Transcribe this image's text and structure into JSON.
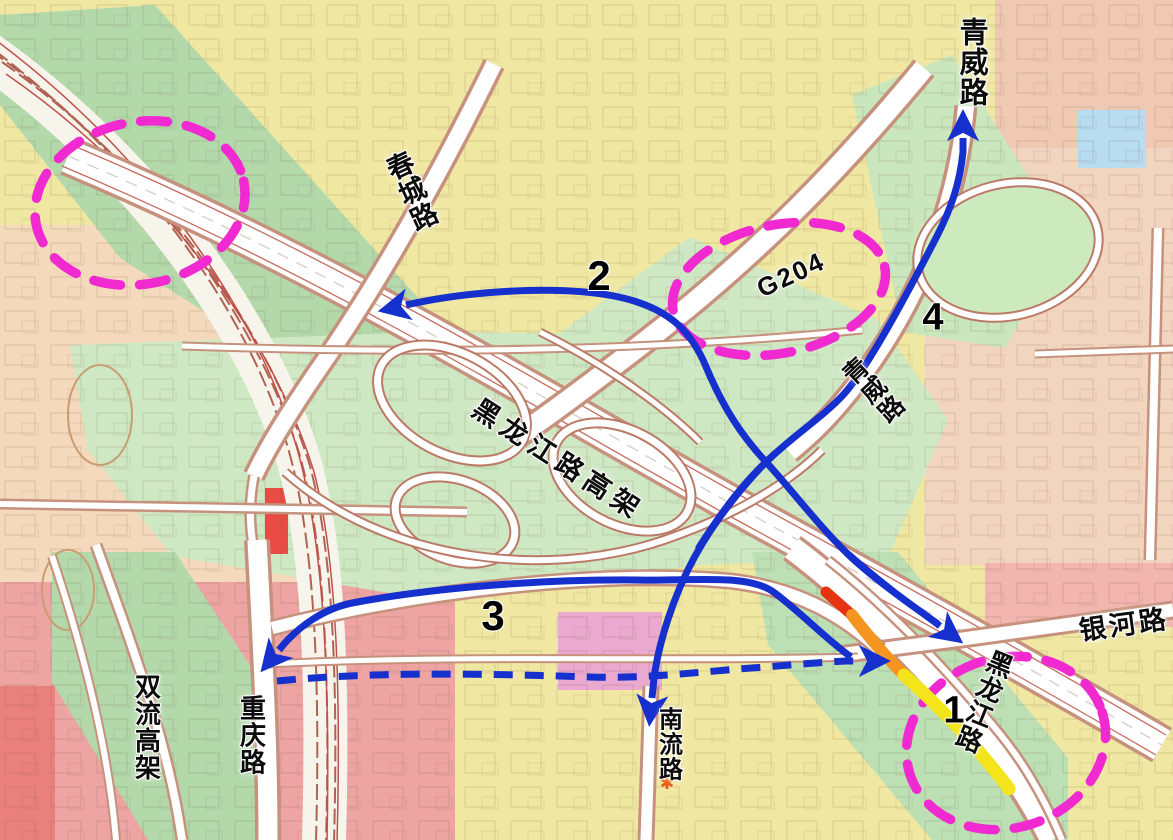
{
  "figure": {
    "kind": "traffic-detour-planning-map",
    "width_px": 1173,
    "height_px": 840
  },
  "colors": {
    "route_arrow_blue": "#1530cd",
    "highlight_magenta": "#f02ad0",
    "congestion_severe_red": "#e63312",
    "congestion_moderate_orange": "#f5941e",
    "congestion_light_yellow": "#f4e41c",
    "parcel_yellow": "#f0e8a2",
    "parcel_green": "#cfe8c4",
    "parcel_salmon": "#f5d9bc",
    "parcel_pink": "#eda4a2",
    "parcel_blue": "#b8dcf0"
  },
  "map": {
    "road_labels": [
      {
        "id": "qingwei-road-north",
        "text": "青威路",
        "x": 971,
        "y": 62,
        "rot": 0,
        "vertical": true,
        "size": 29
      },
      {
        "id": "chuncheng-road",
        "text": "春城路",
        "x": 410,
        "y": 192,
        "rot": -25,
        "vertical": true,
        "size": 27
      },
      {
        "id": "g204",
        "text": "G204",
        "x": 791,
        "y": 275,
        "rot": -25,
        "vertical": false,
        "size": 26,
        "spacing": 2
      },
      {
        "id": "heilongjiang-viaduct",
        "text": "黑龙江路高架",
        "x": 558,
        "y": 460,
        "rot": 33,
        "vertical": false,
        "size": 27,
        "spacing": 6
      },
      {
        "id": "qingwei-road-mid",
        "text": "青威路",
        "x": 872,
        "y": 391,
        "rot": -43,
        "vertical": true,
        "size": 25
      },
      {
        "id": "yinhe-road",
        "text": "银河路",
        "x": 1124,
        "y": 625,
        "rot": -8,
        "vertical": false,
        "size": 27,
        "spacing": 3
      },
      {
        "id": "heilongjiang-road",
        "text": "黑龙江路",
        "x": 983,
        "y": 701,
        "rot": 22,
        "vertical": true,
        "size": 26
      },
      {
        "id": "shuangliu-viaduct",
        "text": "双流高架",
        "x": 146,
        "y": 727,
        "rot": 0,
        "vertical": true,
        "size": 26
      },
      {
        "id": "chongqing-road",
        "text": "重庆路",
        "x": 251,
        "y": 735,
        "rot": 0,
        "vertical": true,
        "size": 26
      },
      {
        "id": "nanliu-road",
        "text": "南流路",
        "x": 667,
        "y": 744,
        "rot": 0,
        "vertical": true,
        "size": 24
      }
    ],
    "route_numbers": [
      {
        "id": "1",
        "text": "1",
        "x": 954,
        "y": 711,
        "size": 38
      },
      {
        "id": "2",
        "text": "2",
        "x": 599,
        "y": 276,
        "size": 42
      },
      {
        "id": "3",
        "text": "3",
        "x": 493,
        "y": 616,
        "size": 42
      },
      {
        "id": "4",
        "text": "4",
        "x": 933,
        "y": 318,
        "size": 38
      }
    ],
    "routes": [
      {
        "id": "2-to-chuncheng",
        "d": "M 938 624 C 908 603 876 580 852 558 C 820 528 792 490 766 462 C 741 435 723 407 707 369 C 692 332 670 307 614 296 C 556 285 468 291 406 305"
      },
      {
        "id": "1-to-heilongjiang",
        "d": "M 848 554 C 880 582 904 600 924 614 L 940 626"
      },
      {
        "id": "4-to-qingwei",
        "d": "M 698 549 C 724 508 744 483 766 462 C 794 435 824 416 844 394 C 868 367 906 296 936 238 C 952 207 960 182 963 152 L 963 138"
      },
      {
        "id": "4-to-nanliu",
        "d": "M 770 458 C 744 484 714 521 694 558 C 674 595 659 641 654 678 L 652 698"
      },
      {
        "id": "3-to-chongqing",
        "d": "M 851 657 C 827 640 795 607 772 591 C 746 574 696 581 638 580 C 528 579 420 590 352 603 C 322 609 298 628 284 644 L 279 650"
      },
      {
        "id": "dashed-east",
        "d": "M 277 681 C 370 672 470 673 590 677 C 650 679 704 671 766 667 C 800 664 826 662 846 661 L 862 661",
        "dash": "19 12"
      }
    ],
    "congestion_segments": [
      {
        "id": "severe",
        "color": "#e63312",
        "w": 11,
        "d": "M 826 592 L 852 615"
      },
      {
        "id": "moderate",
        "color": "#f5941e",
        "w": 12,
        "d": "M 852 615 C 869 637 887 658 904 675"
      },
      {
        "id": "light",
        "color": "#f4e41c",
        "w": 13,
        "d": "M 904 675 C 930 698 960 728 981 754 C 995 771 1004 781 1009 789"
      }
    ],
    "highlight_ellipses": [
      {
        "id": "area-northwest",
        "cx": 140,
        "cy": 203,
        "rx": 106,
        "ry": 81,
        "rot": -12
      },
      {
        "id": "area-g204",
        "cx": 779,
        "cy": 289,
        "rx": 108,
        "ry": 64,
        "rot": -12
      },
      {
        "id": "area-heilongjiang-south",
        "cx": 1006,
        "cy": 743,
        "rx": 101,
        "ry": 85,
        "rot": -18
      }
    ],
    "poi_star": {
      "x": 667,
      "y": 789,
      "glyph": "✱",
      "color": "#e8590f"
    }
  }
}
